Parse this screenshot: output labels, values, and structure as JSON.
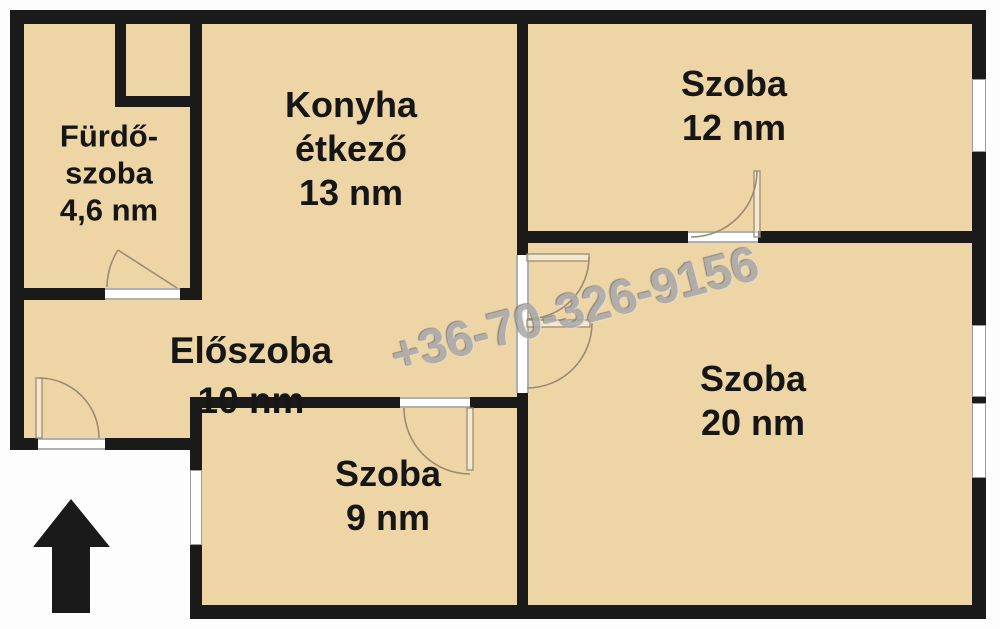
{
  "watermark": {
    "text": "+36-70-326-9156"
  },
  "rooms": [
    {
      "id": "furdoszoba",
      "lines": [
        "Fürdő-",
        "szoba",
        "4,6 nm"
      ]
    },
    {
      "id": "konyha",
      "lines": [
        "Konyha",
        "étkező",
        "13 nm"
      ]
    },
    {
      "id": "szoba12",
      "lines": [
        "Szoba",
        "12 nm"
      ]
    },
    {
      "id": "eloszoba",
      "lines": [
        "Előszoba",
        "10 nm"
      ]
    },
    {
      "id": "szoba20",
      "lines": [
        "Szoba",
        "20 nm"
      ]
    },
    {
      "id": "szoba9",
      "lines": [
        "Szoba",
        "9 nm"
      ]
    }
  ],
  "icons": {
    "entrance_arrow": "up-arrow"
  },
  "colors": {
    "floor": "#eed5a6",
    "wall": "#1a1a1a",
    "outside": "#fdfdfd",
    "door_arc": "#9a8c72",
    "watermark": "#a8a8a8"
  }
}
